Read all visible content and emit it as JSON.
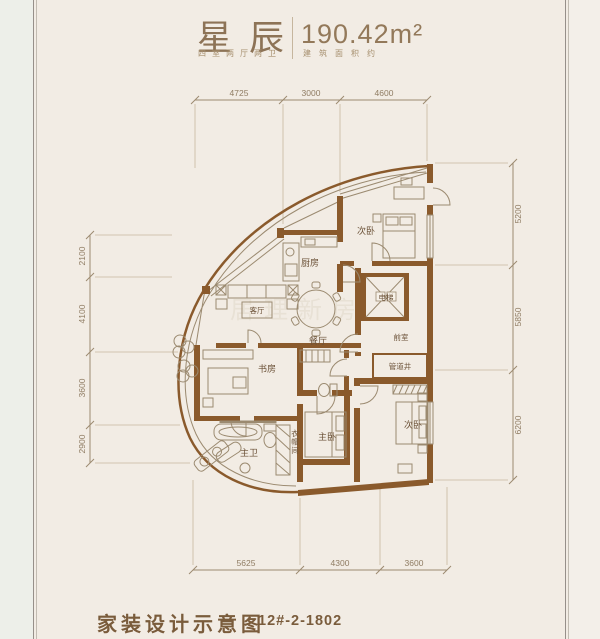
{
  "header": {
    "title": "星辰",
    "title_sub": "四室两厅两卫",
    "area": "190.42m²",
    "area_sub": "建筑面积约"
  },
  "footer": {
    "caption": "家装设计示意图",
    "unit_no": "12#-2-1802"
  },
  "watermark": "居理新房",
  "plan": {
    "rooms": {
      "bedroom_north": "次卧",
      "kitchen": "厨房",
      "living": "客厅",
      "dining": "餐厅",
      "elevator": "电梯",
      "front_room": "前室",
      "pipe_shaft": "管道井",
      "study": "书房",
      "master_bath": "主卫",
      "cloakroom": "衣帽间",
      "master_bedroom": "主卧",
      "bedroom_south": "次卧"
    },
    "dimensions": {
      "top": [
        "4725",
        "3000",
        "4600"
      ],
      "left": [
        "2100",
        "4100",
        "3600",
        "2900"
      ],
      "right": [
        "5200",
        "5850",
        "6200"
      ],
      "bottom": [
        "5625",
        "4300",
        "3600"
      ]
    },
    "colors": {
      "wall": "#8a5a2c",
      "thin_line": "#9b8a70",
      "dim_line": "#b3a088",
      "dim_text": "#8f7c63",
      "label_text": "#6b5137",
      "title_text": "#8d7356",
      "footer_text": "#7a5c3c",
      "background": "#f2ece4"
    }
  }
}
